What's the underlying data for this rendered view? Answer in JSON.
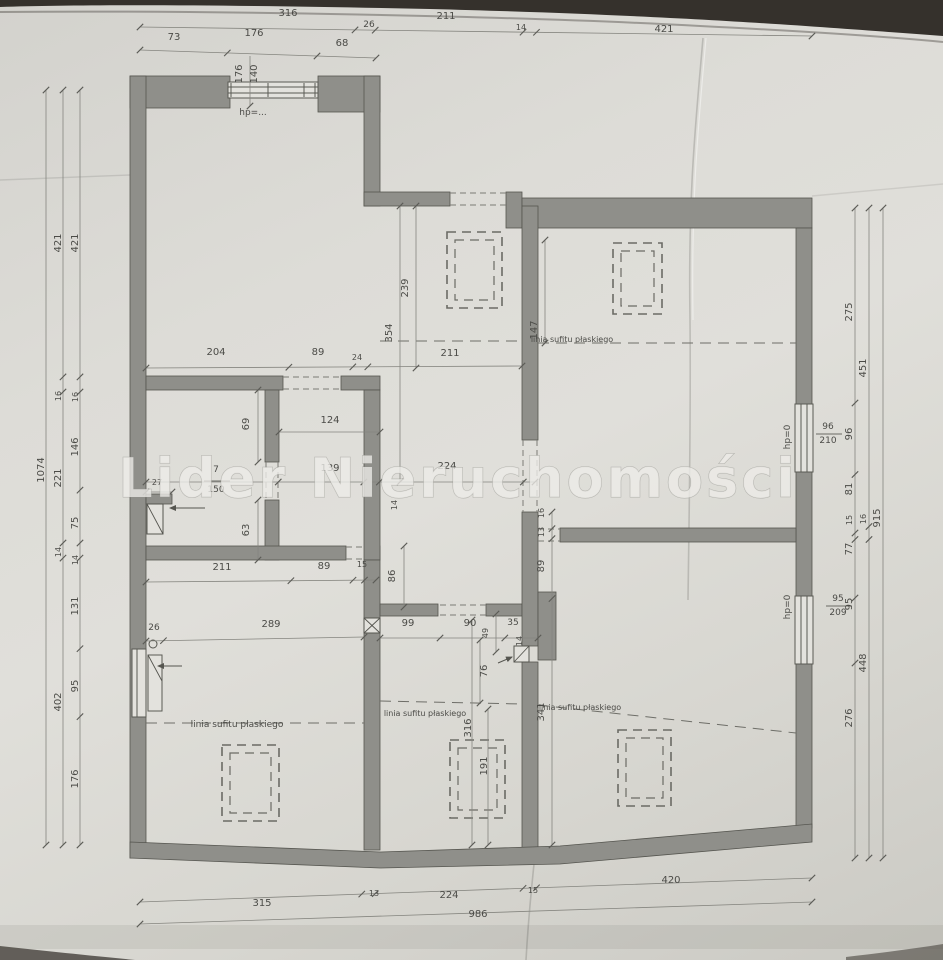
{
  "watermark": "Lider Nieruchomości",
  "window_markers": {
    "top_window_sill": "hp=...",
    "right_window_1_sill": "hp=0",
    "right_window_2_sill": "hp=0",
    "right_window_1_size": {
      "width": "96",
      "height": "210"
    },
    "right_window_2_size": {
      "width": "95",
      "height": "209"
    }
  },
  "ceiling_label": "linia sufitu płaskiego",
  "dimension_chains": {
    "top_row_1": [
      "316",
      "26",
      "211",
      "14",
      "421"
    ],
    "top_row_2": [
      "73",
      "176",
      "68"
    ],
    "top_window": [
      "176",
      "140"
    ],
    "left_total": [
      "1074"
    ],
    "left_mid": [
      "421",
      "16",
      "221",
      "14",
      "402"
    ],
    "left_inner": [
      "421",
      "16",
      "146",
      "75",
      "14",
      "131",
      "95",
      "176"
    ],
    "right_inner": [
      "275",
      "96",
      "81",
      "15",
      "77",
      "95",
      "276"
    ],
    "right_mid": [
      "451",
      "16",
      "448"
    ],
    "right_total": [
      "915"
    ],
    "bottom_row_1": [
      "315",
      "13",
      "224",
      "15",
      "420"
    ],
    "bottom_row_2": [
      "986"
    ],
    "interior_upper": [
      "204",
      "89",
      "24",
      "211"
    ],
    "interior_mid": [
      "124",
      "69",
      "63",
      "27",
      "7",
      "150",
      "139",
      "224",
      "14",
      "86",
      "239",
      "354",
      "147"
    ],
    "interior_right_room": [
      "16",
      "13",
      "89",
      "341"
    ],
    "interior_lower": [
      "99",
      "90",
      "35",
      "49",
      "14",
      "76",
      "316",
      "191"
    ],
    "bottom_left_room": [
      "211",
      "89",
      "15",
      "26",
      "289"
    ]
  },
  "annotations": [
    {
      "t": "316",
      "x": 288,
      "y": 16
    },
    {
      "t": "26",
      "x": 369,
      "y": 27,
      "fs": 9
    },
    {
      "t": "211",
      "x": 446,
      "y": 19
    },
    {
      "t": "14",
      "x": 521,
      "y": 30,
      "fs": 8
    },
    {
      "t": "421",
      "x": 664,
      "y": 32
    },
    {
      "t": "73",
      "x": 174,
      "y": 40
    },
    {
      "t": "176",
      "x": 254,
      "y": 36
    },
    {
      "t": "68",
      "x": 342,
      "y": 46
    },
    {
      "t": "176",
      "x": 242,
      "y": 74,
      "r": -90
    },
    {
      "t": "140",
      "x": 257,
      "y": 74,
      "r": -90
    },
    {
      "t": "hp=...",
      "x": 253,
      "y": 115,
      "fs": 9
    },
    {
      "t": "1074",
      "x": 44,
      "y": 470,
      "r": -90
    },
    {
      "t": "421",
      "x": 61,
      "y": 243,
      "r": -90
    },
    {
      "t": "16",
      "x": 61,
      "y": 396,
      "r": -90,
      "fs": 8
    },
    {
      "t": "221",
      "x": 61,
      "y": 478,
      "r": -90
    },
    {
      "t": "14",
      "x": 61,
      "y": 552,
      "r": -90,
      "fs": 8
    },
    {
      "t": "402",
      "x": 61,
      "y": 702,
      "r": -90
    },
    {
      "t": "421",
      "x": 78,
      "y": 243,
      "r": -90
    },
    {
      "t": "16",
      "x": 78,
      "y": 397,
      "r": -90,
      "fs": 8
    },
    {
      "t": "146",
      "x": 78,
      "y": 447,
      "r": -90
    },
    {
      "t": "75",
      "x": 78,
      "y": 523,
      "r": -90
    },
    {
      "t": "14",
      "x": 78,
      "y": 560,
      "r": -90,
      "fs": 8
    },
    {
      "t": "131",
      "x": 78,
      "y": 606,
      "r": -90
    },
    {
      "t": "95",
      "x": 78,
      "y": 686,
      "r": -90
    },
    {
      "t": "176",
      "x": 78,
      "y": 779,
      "r": -90
    },
    {
      "t": "275",
      "x": 852,
      "y": 312,
      "r": -90
    },
    {
      "t": "96",
      "x": 852,
      "y": 434,
      "r": -90
    },
    {
      "t": "81",
      "x": 852,
      "y": 489,
      "r": -90
    },
    {
      "t": "15",
      "x": 852,
      "y": 520,
      "r": -90,
      "fs": 8
    },
    {
      "t": "77",
      "x": 852,
      "y": 549,
      "r": -90
    },
    {
      "t": "95",
      "x": 852,
      "y": 604,
      "r": -90
    },
    {
      "t": "276",
      "x": 852,
      "y": 718,
      "r": -90
    },
    {
      "t": "451",
      "x": 866,
      "y": 368,
      "r": -90
    },
    {
      "t": "16",
      "x": 866,
      "y": 519,
      "r": -90,
      "fs": 8
    },
    {
      "t": "448",
      "x": 866,
      "y": 663,
      "r": -90
    },
    {
      "t": "915",
      "x": 880,
      "y": 518,
      "r": -90
    },
    {
      "t": "96",
      "x": 828,
      "y": 429,
      "fs": 9
    },
    {
      "t": "210",
      "x": 828,
      "y": 443,
      "fs": 9
    },
    {
      "t": "95",
      "x": 838,
      "y": 601,
      "fs": 9
    },
    {
      "t": "209",
      "x": 838,
      "y": 615,
      "fs": 9
    },
    {
      "t": "hp=0",
      "x": 790,
      "y": 437,
      "r": -90,
      "fs": 9
    },
    {
      "t": "hp=0",
      "x": 790,
      "y": 607,
      "r": -90,
      "fs": 9
    },
    {
      "t": "315",
      "x": 262,
      "y": 906
    },
    {
      "t": "13",
      "x": 374,
      "y": 896,
      "fs": 8
    },
    {
      "t": "224",
      "x": 449,
      "y": 898
    },
    {
      "t": "15",
      "x": 533,
      "y": 893,
      "fs": 8
    },
    {
      "t": "420",
      "x": 671,
      "y": 883
    },
    {
      "t": "986",
      "x": 478,
      "y": 917
    },
    {
      "t": "204",
      "x": 216,
      "y": 355
    },
    {
      "t": "89",
      "x": 318,
      "y": 355
    },
    {
      "t": "24",
      "x": 357,
      "y": 360,
      "fs": 8
    },
    {
      "t": "211",
      "x": 450,
      "y": 356
    },
    {
      "t": "124",
      "x": 330,
      "y": 423
    },
    {
      "t": "69",
      "x": 249,
      "y": 424,
      "r": -90
    },
    {
      "t": "63",
      "x": 249,
      "y": 530,
      "r": -90
    },
    {
      "t": "27",
      "x": 157,
      "y": 485,
      "fs": 8
    },
    {
      "t": "7",
      "x": 216,
      "y": 472,
      "fs": 9
    },
    {
      "t": "150",
      "x": 216,
      "y": 492,
      "fs": 9
    },
    {
      "t": "139",
      "x": 330,
      "y": 471
    },
    {
      "t": "224",
      "x": 447,
      "y": 469
    },
    {
      "t": "14",
      "x": 397,
      "y": 505,
      "r": -90,
      "fs": 8
    },
    {
      "t": "86",
      "x": 395,
      "y": 576,
      "r": -90
    },
    {
      "t": "239",
      "x": 408,
      "y": 288,
      "r": -90
    },
    {
      "t": "354",
      "x": 392,
      "y": 333,
      "r": -90
    },
    {
      "t": "147",
      "x": 537,
      "y": 330,
      "r": -90
    },
    {
      "t": "16",
      "x": 544,
      "y": 513,
      "r": -90,
      "fs": 8
    },
    {
      "t": "13",
      "x": 544,
      "y": 532,
      "r": -90,
      "fs": 8
    },
    {
      "t": "89",
      "x": 544,
      "y": 566,
      "r": -90
    },
    {
      "t": "341",
      "x": 544,
      "y": 712,
      "r": -90
    },
    {
      "t": "99",
      "x": 408,
      "y": 626
    },
    {
      "t": "90",
      "x": 470,
      "y": 626
    },
    {
      "t": "35",
      "x": 513,
      "y": 625,
      "fs": 9
    },
    {
      "t": "49",
      "x": 488,
      "y": 633,
      "r": -90,
      "fs": 8
    },
    {
      "t": "14",
      "x": 522,
      "y": 641,
      "r": -90,
      "fs": 8
    },
    {
      "t": "76",
      "x": 487,
      "y": 671,
      "r": -90
    },
    {
      "t": "316",
      "x": 471,
      "y": 728,
      "r": -90
    },
    {
      "t": "191",
      "x": 487,
      "y": 766,
      "r": -90
    },
    {
      "t": "211",
      "x": 222,
      "y": 570
    },
    {
      "t": "89",
      "x": 324,
      "y": 569
    },
    {
      "t": "15",
      "x": 362,
      "y": 567,
      "fs": 8
    },
    {
      "t": "26",
      "x": 154,
      "y": 630,
      "fs": 9
    },
    {
      "t": "289",
      "x": 271,
      "y": 627
    },
    {
      "t": "linia sufitu płaskiego",
      "x": 572,
      "y": 342,
      "fs": 8
    },
    {
      "t": "linia sufitu płaskiego",
      "x": 237,
      "y": 727,
      "fs": 9
    },
    {
      "t": "linia sufitu płaskiego",
      "x": 425,
      "y": 716,
      "fs": 8
    },
    {
      "t": "linia sufitu płaskiego",
      "x": 580,
      "y": 710,
      "fs": 8
    }
  ]
}
